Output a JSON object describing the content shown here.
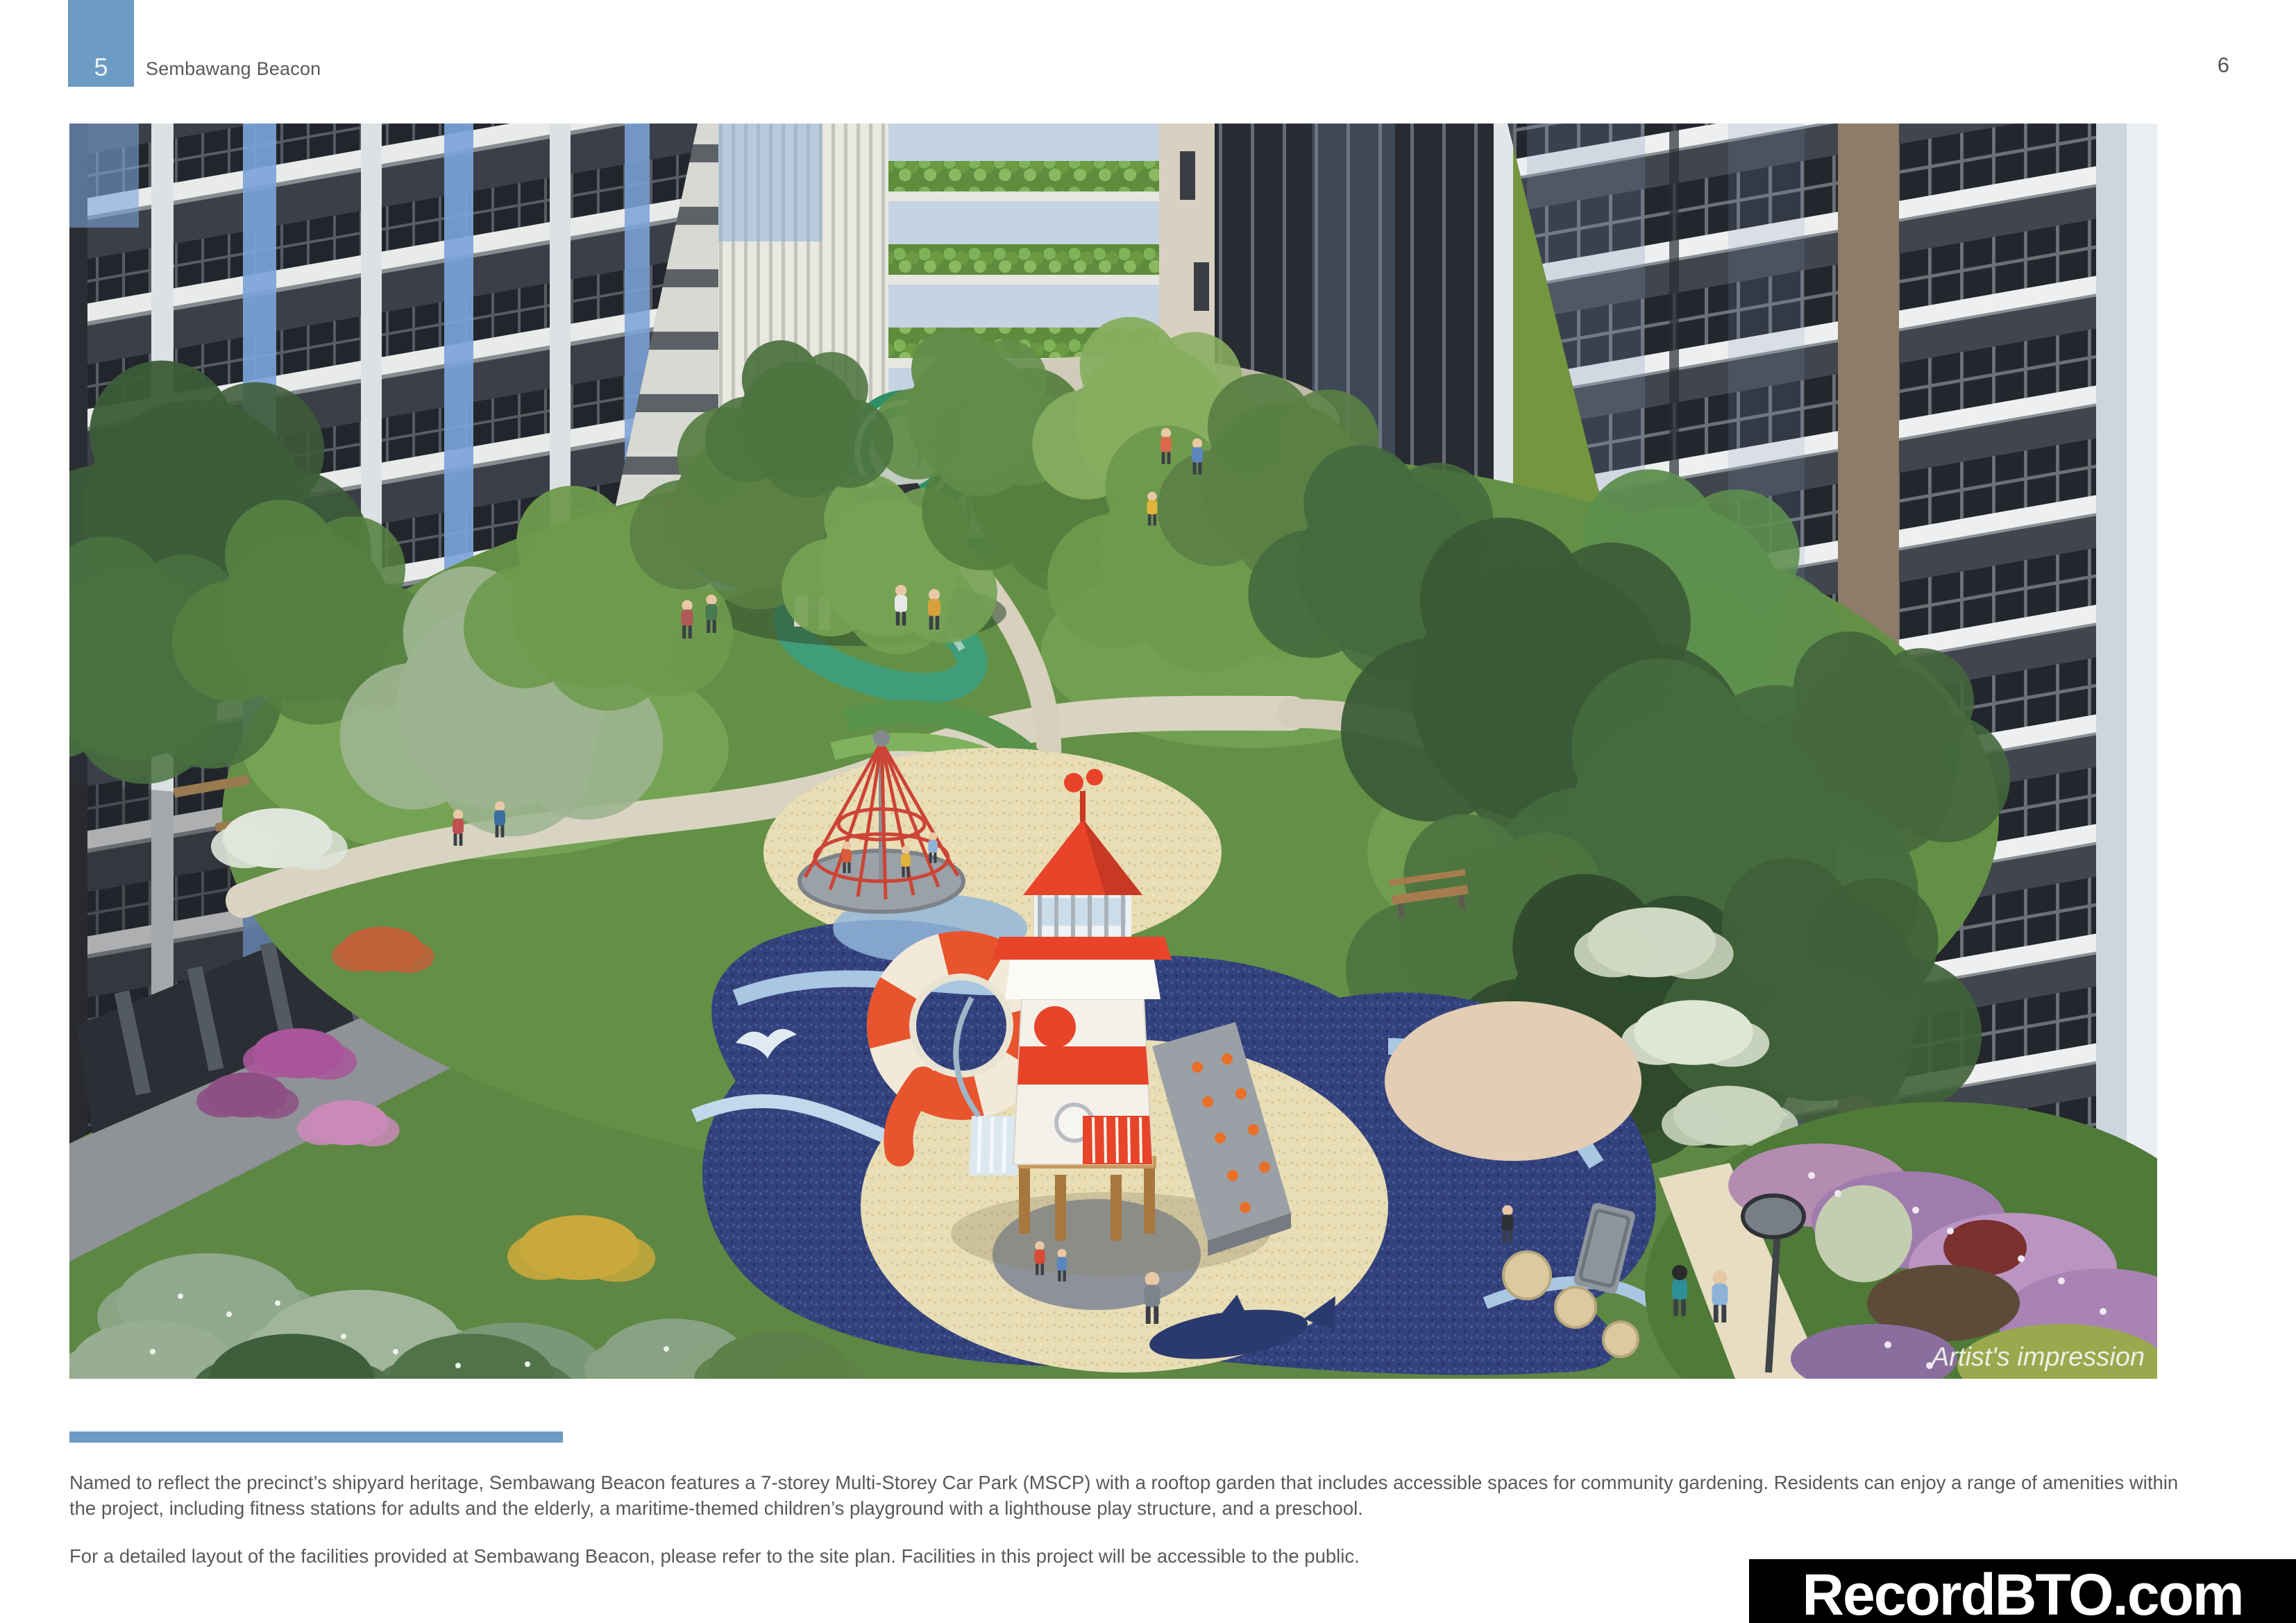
{
  "header": {
    "chapter_number": "5",
    "title": "Sembawang Beacon",
    "page_number": "6"
  },
  "image": {
    "caption": "Artist's impression"
  },
  "body": {
    "paragraph1": "Named to reflect the precinct’s shipyard heritage, Sembawang Beacon features a 7-storey Multi-Storey Car Park (MSCP) with a rooftop garden that includes accessible spaces for community gardening. Residents can enjoy a range of amenities within the project, including fitness stations for adults and the elderly, a maritime-themed children’s playground with a lighthouse play structure, and a preschool.",
    "paragraph2": "For a detailed layout of the facilities provided at Sembawang Beacon, please refer to the site plan. Facilities in this project will be accessible to the public."
  },
  "watermark": {
    "text": "RecordBTO.com"
  },
  "colors": {
    "accent_blue": "#6C9BC3",
    "text_gray": "#58595B",
    "watermark_bg": "#000000",
    "watermark_text": "#FFFFFF",
    "lighthouse_red": "#E8442A",
    "playground_navy": "#33427C",
    "facade_dark": "#3B3F47"
  }
}
